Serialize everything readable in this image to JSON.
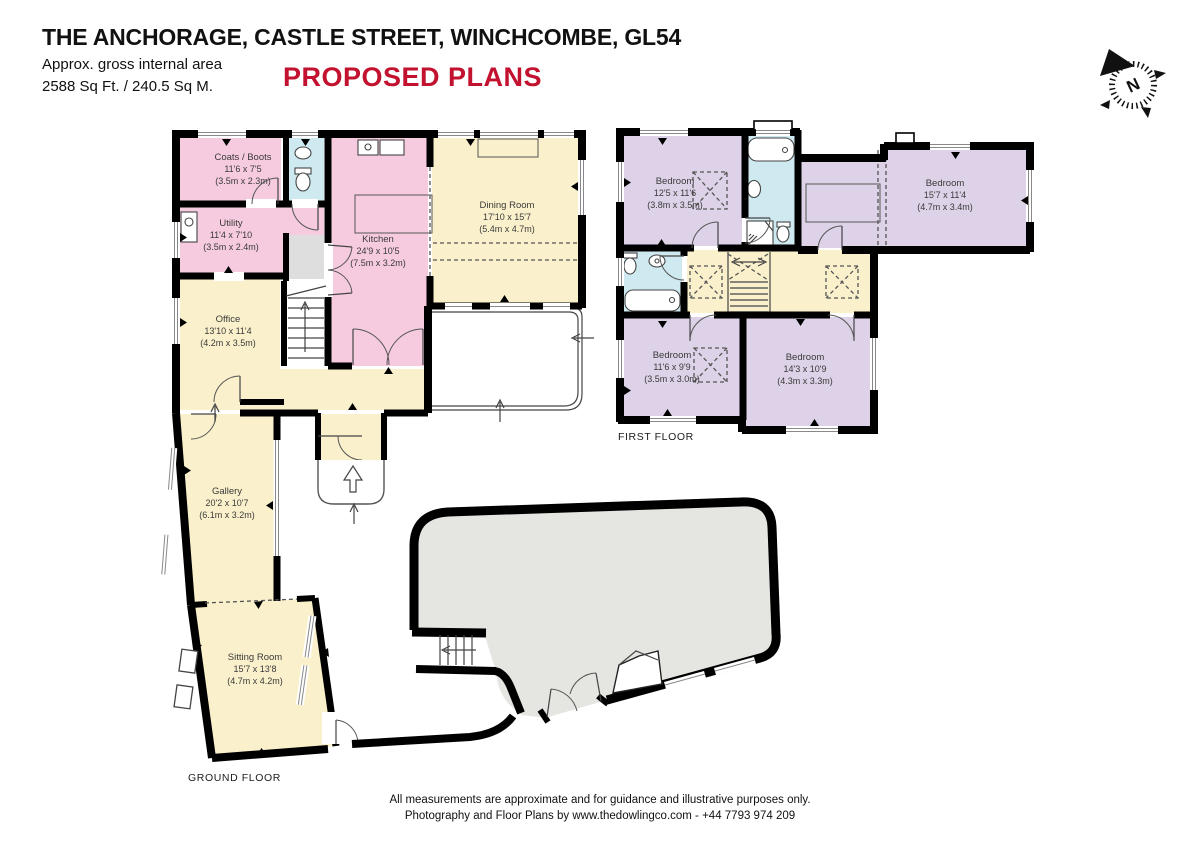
{
  "header": {
    "title": "THE ANCHORAGE, CASTLE STREET, WINCHCOMBE, GL54",
    "area_line1": "Approx. gross internal area",
    "area_line2": "2588 Sq Ft. / 240.5 Sq M.",
    "plan_type": "PROPOSED PLANS"
  },
  "compass": {
    "n": "N"
  },
  "floors": {
    "ground": {
      "label": "GROUND FLOOR",
      "rooms": {
        "coats": {
          "name": "Coats / Boots",
          "ft": "11'6 x 7'5",
          "m": "(3.5m x 2.3m)"
        },
        "utility": {
          "name": "Utility",
          "ft": "11'4 x 7'10",
          "m": "(3.5m x 2.4m)"
        },
        "kitchen": {
          "name": "Kitchen",
          "ft": "24'9 x 10'5",
          "m": "(7.5m x 3.2m)"
        },
        "dining": {
          "name": "Dining Room",
          "ft": "17'10 x 15'7",
          "m": "(5.4m x 4.7m)"
        },
        "office": {
          "name": "Office",
          "ft": "13'10 x 11'4",
          "m": "(4.2m x 3.5m)"
        },
        "gallery": {
          "name": "Gallery",
          "ft": "20'2 x 10'7",
          "m": "(6.1m x 3.2m)"
        },
        "sitting": {
          "name": "Sitting Room",
          "ft": "15'7 x 13'8",
          "m": "(4.7m x 4.2m)"
        }
      }
    },
    "first": {
      "label": "FIRST FLOOR",
      "rooms": {
        "bed1": {
          "name": "Bedroom",
          "ft": "12'5 x 11'6",
          "m": "(3.8m x 3.5m)"
        },
        "bed2": {
          "name": "Bedroom",
          "ft": "15'7 x 11'4",
          "m": "(4.7m x 3.4m)"
        },
        "bed3": {
          "name": "Bedroom",
          "ft": "11'6 x 9'9",
          "m": "(3.5m x 3.0m)"
        },
        "bed4": {
          "name": "Bedroom",
          "ft": "14'3 x 10'9",
          "m": "(4.3m x 3.3m)"
        }
      }
    }
  },
  "footer": {
    "line1": "All measurements are approximate and for guidance and illustrative purposes only.",
    "line2": "Photography and Floor Plans by www.thedowlingco.com - +44 7793 974 209"
  },
  "colors": {
    "accent_red": "#c3122f",
    "room_pink": "#f6cbdf",
    "room_yellow": "#faf1cc",
    "room_blue": "#cfe9f0",
    "room_purple": "#ddd2e7",
    "area_gray": "#e5e5e2",
    "wall_black": "#000000"
  }
}
